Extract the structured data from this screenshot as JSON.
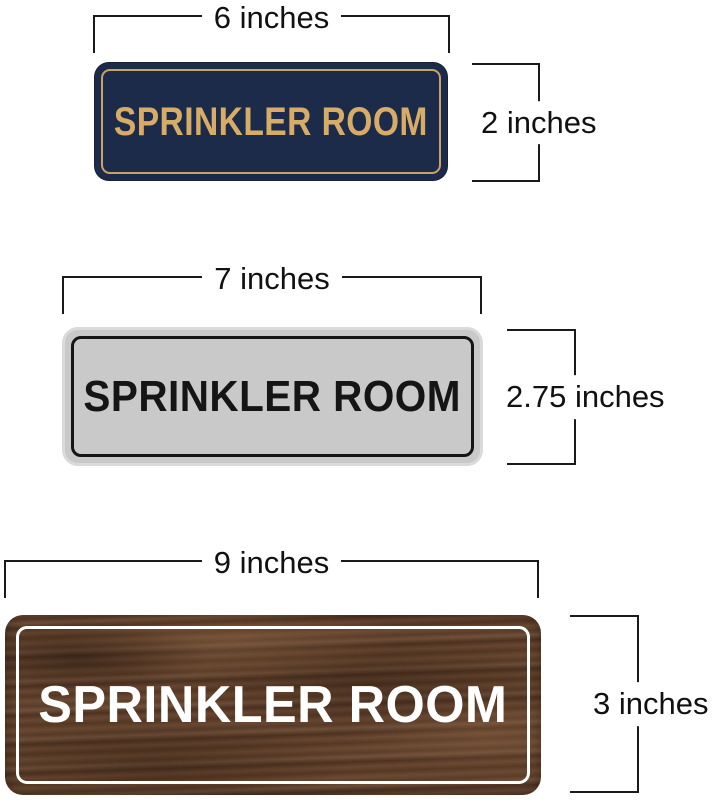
{
  "page": {
    "background_color": "#ffffff",
    "description": "Size comparison diagram of three SPRINKLER ROOM door signs with measurement brackets"
  },
  "dimension_style": {
    "line_color": "#1a1a1a",
    "label_color": "#111111"
  },
  "signs": [
    {
      "name": "navy-gold-sign",
      "text": "SPRINKLER ROOM",
      "width_label": "6 inches",
      "height_label": "2 inches",
      "colors": {
        "background": "#1d2b4a",
        "inner_border": "#c9a366",
        "text": "#d7ac66"
      }
    },
    {
      "name": "silver-black-sign",
      "text": "SPRINKLER ROOM",
      "width_label": "7 inches",
      "height_label": "2.75 inches",
      "colors": {
        "background": "#c9c9c9",
        "rim": "#dadada",
        "inner_border": "#151515",
        "text": "#151515"
      }
    },
    {
      "name": "walnut-wood-sign",
      "text": "SPRINKLER ROOM",
      "width_label": "9 inches",
      "height_label": "3 inches",
      "colors": {
        "background": "#5d3f2b",
        "inner_border": "#ffffff",
        "text": "#ffffff"
      }
    }
  ]
}
